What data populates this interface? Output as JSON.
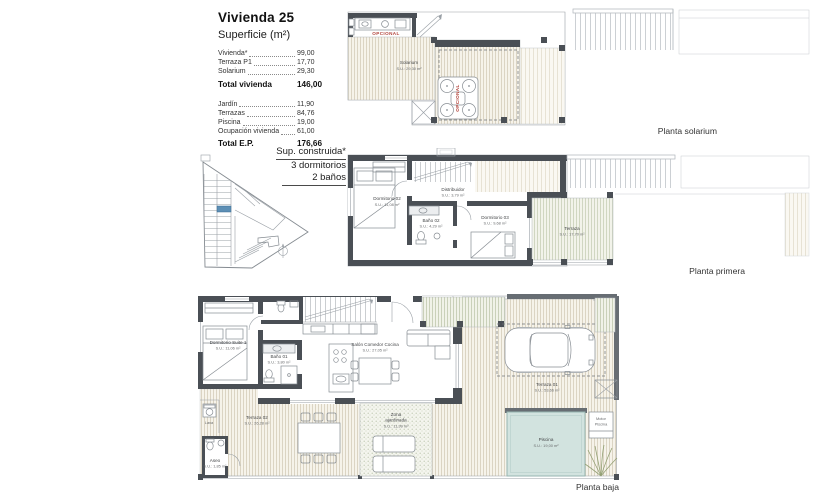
{
  "info_panel": {
    "title": "Vivienda 25",
    "subtitle": "Superficie (m²)",
    "rows_vivienda": [
      {
        "label": "Vivienda*",
        "value": "99,00"
      },
      {
        "label": "Terraza P1",
        "value": "17,70"
      },
      {
        "label": "Solarium",
        "value": "29,30"
      }
    ],
    "total_vivienda": {
      "label": "Total vivienda",
      "value": "146,00"
    },
    "rows_parcela": [
      {
        "label": "Jardín",
        "value": "11,90"
      },
      {
        "label": "Terrazas",
        "value": "84,76"
      },
      {
        "label": "Piscina",
        "value": "19,00"
      },
      {
        "label": "Ocupación vivienda",
        "value": "61,00"
      }
    ],
    "total_parcela": {
      "label": "Total E.P.",
      "value": "176,66"
    },
    "built": {
      "line1": "Sup. construida*",
      "line2": "3 dormitorios",
      "line3": "2 baños"
    }
  },
  "colors": {
    "wall": "#4a4f55",
    "accent_red": "#b1423a",
    "highlight_blue": "#5d8fb5",
    "pool": "#d2e3df"
  },
  "plan_solarium": {
    "caption": "Planta solarium",
    "optional_kitchen": "OPCIONAL",
    "optional_jacuzzi": "OPCIONAL",
    "room": {
      "name": "Solarium",
      "area": "S.U.: 29,30 m²"
    }
  },
  "plan_primera": {
    "caption": "Planta primera",
    "rooms": {
      "dorm02": {
        "name": "Dormitorio 02",
        "area": "S.U.: 11,08 m²"
      },
      "distribuidor": {
        "name": "Distribuidor",
        "area": "S.U.: 3,79 m²"
      },
      "bano02": {
        "name": "Baño 02",
        "area": "S.U.: 4,29 m²"
      },
      "dorm03": {
        "name": "Dormitorio 03",
        "area": "S.U.: 9,68 m²"
      },
      "terraza": {
        "name": "Terraza",
        "area": "S.U.: 17,70 m²"
      }
    }
  },
  "plan_baja": {
    "caption": "Planta baja",
    "rooms": {
      "suite": {
        "name": "Dormitorio Suite 1",
        "area": "S.U.: 11,06 m²"
      },
      "bano01": {
        "name": "Baño 01",
        "area": "S.U.: 3,80 m²"
      },
      "salon": {
        "name": "Salón Comedor Cocina",
        "area": "S.U.: 27,05 m²"
      },
      "terraza01": {
        "name": "Terraza 01",
        "area": "S.U.: 53,66 m²"
      },
      "terraza02": {
        "name": "Terraza 02",
        "area": "S.U.: 26,28 m²"
      },
      "zona": {
        "line1": "Zona",
        "line2": "ajardinada",
        "area": "S.U.: 11,99 m²"
      },
      "piscina": {
        "name": "Piscina",
        "area": "S.U.: 19,00 m²"
      },
      "aseo": {
        "name": "Aseo",
        "area": "S.U.: 1,85 m²"
      },
      "lava": {
        "name": "Lava"
      },
      "motor": {
        "line1": "Motor",
        "line2": "Piscina"
      }
    }
  }
}
